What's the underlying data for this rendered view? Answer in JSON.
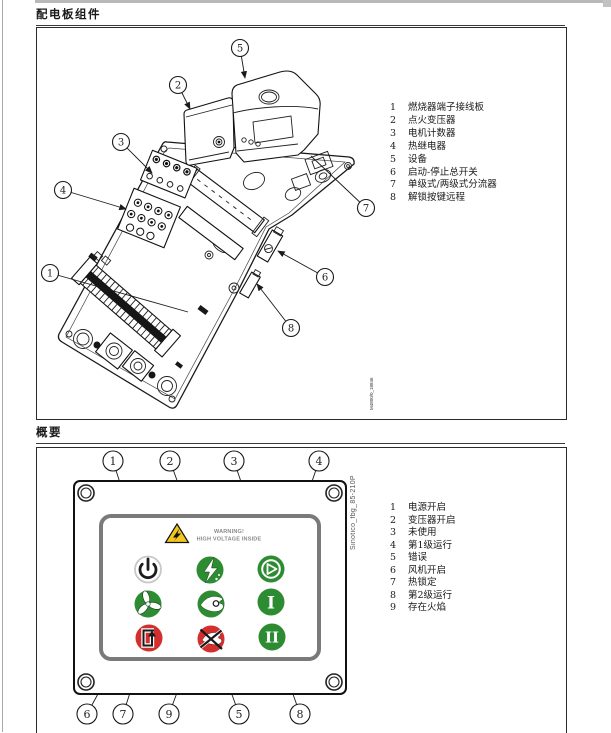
{
  "figure1": {
    "title": "配电板组件",
    "drawing_code": "M4800/0_18846",
    "callouts": {
      "c1": "1",
      "c2": "2",
      "c3": "3",
      "c4": "4",
      "c5": "5",
      "c6": "6",
      "c7": "7",
      "c8": "8"
    },
    "legend": [
      {
        "num": "1",
        "label": "燃烧器端子接线板"
      },
      {
        "num": "2",
        "label": "点火变压器"
      },
      {
        "num": "3",
        "label": "电机计数器"
      },
      {
        "num": "4",
        "label": "热继电器"
      },
      {
        "num": "5",
        "label": "设备"
      },
      {
        "num": "6",
        "label": "启动-停止总开关"
      },
      {
        "num": "7",
        "label": "单级式/两级式分流器"
      },
      {
        "num": "8",
        "label": "解锁按键远程"
      }
    ]
  },
  "figure2": {
    "title": "概要",
    "side_code": "Sinotico_fbg_85-210P",
    "panel": {
      "warning_line1": "WARNING!",
      "warning_line2": "HIGH VOLTAGE INSIDE",
      "stage1_label": "I",
      "stage2_label": "II"
    },
    "colors": {
      "green": "#2d8c31",
      "red": "#d32f2f",
      "yellow": "#f2c71d"
    },
    "callouts_top": {
      "c1": "1",
      "c2": "2",
      "c3": "3",
      "c4": "4"
    },
    "callouts_bottom": {
      "c6": "6",
      "c7": "7",
      "c9": "9",
      "c5": "5",
      "c8": "8"
    },
    "legend": [
      {
        "num": "1",
        "label": "电源开启"
      },
      {
        "num": "2",
        "label": "变压器开启"
      },
      {
        "num": "3",
        "label": "未使用"
      },
      {
        "num": "4",
        "label": "第1级运行"
      },
      {
        "num": "5",
        "label": "错误"
      },
      {
        "num": "6",
        "label": "风机开启"
      },
      {
        "num": "7",
        "label": "热锁定"
      },
      {
        "num": "8",
        "label": "第2级运行"
      },
      {
        "num": "9",
        "label": "存在火焰"
      }
    ]
  }
}
